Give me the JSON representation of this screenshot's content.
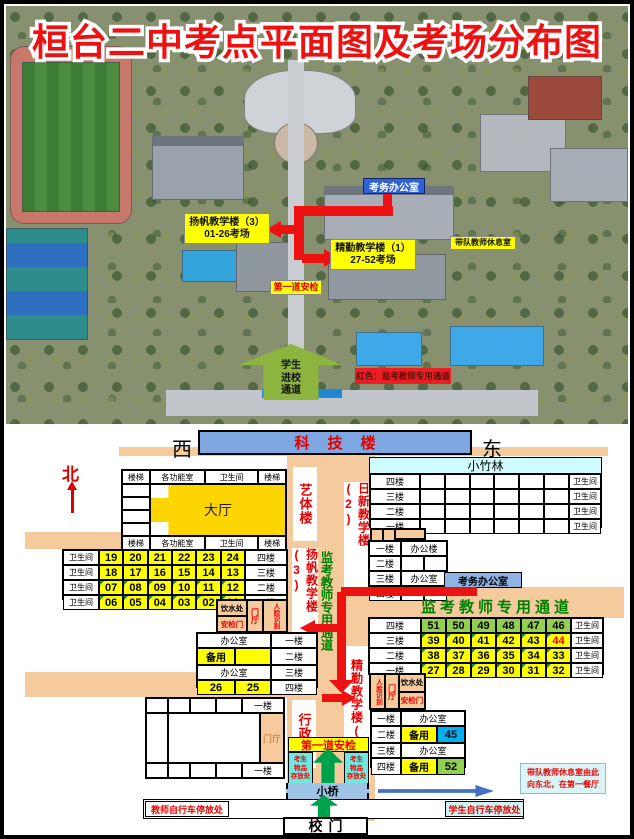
{
  "title": "桓台二中考点平面图及考场分布图",
  "colors": {
    "accent_red": "#EE1111",
    "corridor": "#F5CB9E",
    "room_yellow": "#FFFF00",
    "room_green": "#92D050",
    "room_blue": "#00B0F0",
    "keji_blue": "#7EA6E0",
    "cyan_note": "#CCFFFF",
    "channel_green": "#008000",
    "storage_teal": "#70E8DF"
  },
  "photo": {
    "exam_office": "考务办公室",
    "yangfan": {
      "line1": "扬帆教学楼（3）",
      "line2": "01-26考场"
    },
    "jingqin": {
      "line1": "精勤教学楼（1）",
      "line2": "27-52考场"
    },
    "team_rest": "带队教师休息室",
    "first_security": "第一道安检",
    "student_channel": {
      "line1": "学生",
      "line2": "进校",
      "line3": "通道"
    },
    "red_note": "红色：监考教师专用通道"
  },
  "plan": {
    "compass": {
      "north": "北",
      "west": "西",
      "east": "东"
    },
    "keji": "科技楼",
    "xiaozhulin": "小竹林",
    "yiti_label": "艺体楼",
    "rixin_label": "日新教学楼(2)",
    "yangfan_label": "扬帆教学楼(3)",
    "jingqin_label": "精勤教学楼(1)",
    "xingzheng_label": "行政楼",
    "invig_channel_vertical": "监考教师专用通道",
    "invig_channel_banner": "监考教师专用通道",
    "dating": "大厅",
    "louti": "楼梯",
    "gongnengshi": "各功能室",
    "weishengjian": "卫生间",
    "bangongshi": "办公室",
    "bangonglou": "办公楼",
    "beiyong": "备用",
    "yinshuichu": "饮水处",
    "anjianmen": "安检门",
    "menting": "门厅",
    "renlian": "人脸识别",
    "exam_office": "考务办公室",
    "floors": {
      "f1": "一楼",
      "f2": "二楼",
      "f3": "三楼",
      "f4": "四楼"
    },
    "yangfan_rooms": [
      [
        "19",
        "20",
        "21",
        "22",
        "23",
        "24"
      ],
      [
        "18",
        "17",
        "16",
        "15",
        "14",
        "13"
      ],
      [
        "07",
        "08",
        "09",
        "10",
        "11",
        "12"
      ],
      [
        "06",
        "05",
        "04",
        "03",
        "02",
        "01"
      ]
    ],
    "jingqin_rooms": [
      [
        "51",
        "50",
        "49",
        "48",
        "47",
        "46"
      ],
      [
        "39",
        "40",
        "41",
        "42",
        "43",
        "44"
      ],
      [
        "38",
        "37",
        "36",
        "35",
        "34",
        "33"
      ],
      [
        "27",
        "28",
        "29",
        "30",
        "31",
        "32"
      ]
    ],
    "left_office": {
      "beiyong": "备用",
      "r26": "26",
      "r25": "25"
    },
    "right_office": {
      "beiyong2f": "备用",
      "r45": "45",
      "beiyong4f": "备用",
      "r52": "52"
    },
    "first_security": "第一道安检",
    "items_storage": {
      "line1": "考生",
      "line2": "物品",
      "line3": "存放处"
    },
    "bridge": "小桥",
    "gate": "校门",
    "teacher_bike": "教师自行车停放处",
    "student_bike": "学生自行车停放处",
    "note": {
      "line1": "带队教师休息室由此",
      "line2": "向东北，在第一餐厅"
    }
  }
}
